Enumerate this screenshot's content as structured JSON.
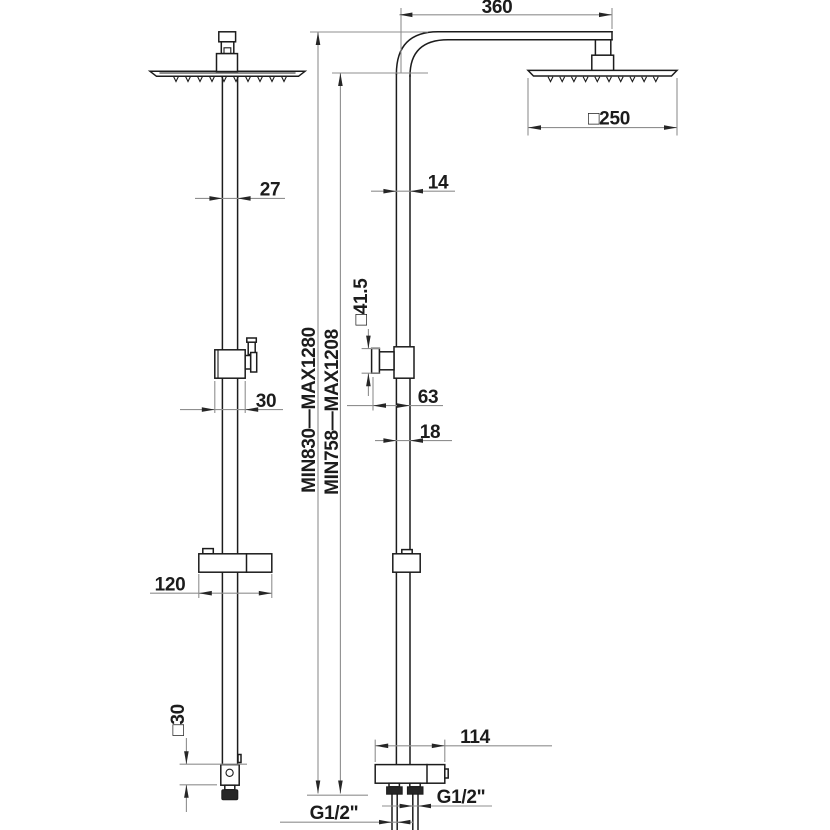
{
  "meta": {
    "title": "Shower column technical dimension drawing",
    "views": {
      "left": "side view",
      "right": "front view"
    }
  },
  "colors": {
    "background": "#ffffff",
    "object_line": "#1c1c1c",
    "dimension_line": "#8f8f8f",
    "arrow": "#262626",
    "text": "#1c1c1c"
  },
  "labels": {
    "arm_length": "360",
    "head_width": "□250",
    "pipe_width_side": "27",
    "pipe_width_front": "14",
    "diverter_size": "□41.5",
    "height_range_outer": "MIN830—MAX1280",
    "height_range_inner": "MIN758—MAX1208",
    "diverter_offset": "63",
    "lower_pipe_width": "18",
    "diverter_width_side": "30",
    "slider_bracket_length": "120",
    "base_size": "□30",
    "wall_bracket_width": "114",
    "outlet_thread_right": "G1/2\"",
    "outlet_thread_left": "G1/2\""
  }
}
